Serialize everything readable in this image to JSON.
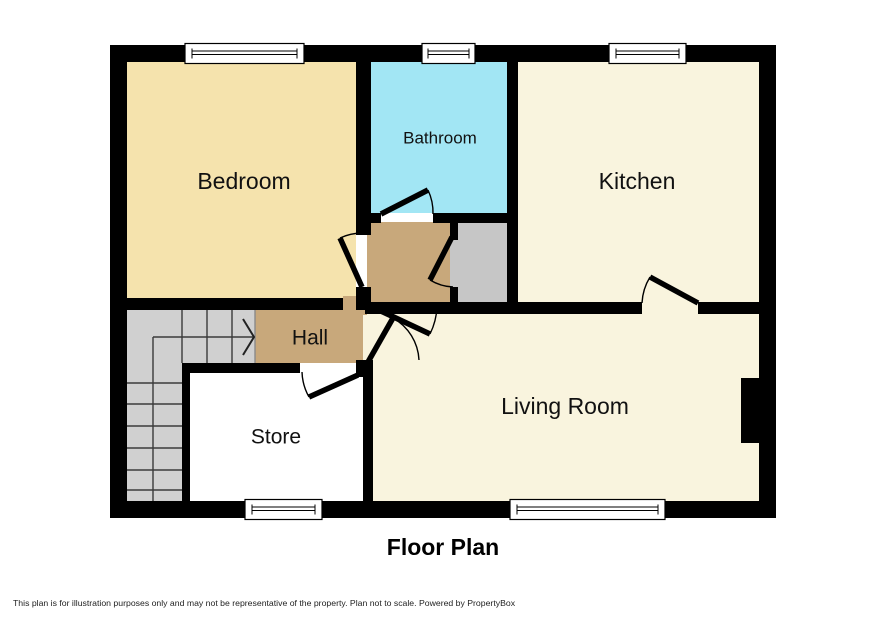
{
  "floor_plan": {
    "title": "Floor Plan",
    "disclaimer": "This plan is for illustration purposes only and may not be representative of the property. Plan not to scale. Powered by PropertyBox",
    "wall_color": "#000000",
    "background": "#ffffff",
    "text_color": "#111111",
    "rooms": {
      "bedroom": {
        "label": "Bedroom",
        "color": "#f5e3ad"
      },
      "bathroom": {
        "label": "Bathroom",
        "color": "#a2e6f4"
      },
      "kitchen": {
        "label": "Kitchen",
        "color": "#f9f4de"
      },
      "hall": {
        "label": "Hall",
        "color": "#c8a87b"
      },
      "store": {
        "label": "Store",
        "color": "#c6c6c6"
      },
      "living_room": {
        "label": "Living Room",
        "color": "#f9f4de"
      },
      "landing": {
        "color": "#c8a87b"
      },
      "cupboard": {
        "color": "#c6c6c6"
      },
      "stairs": {
        "color": "#d0d0d0"
      }
    }
  }
}
